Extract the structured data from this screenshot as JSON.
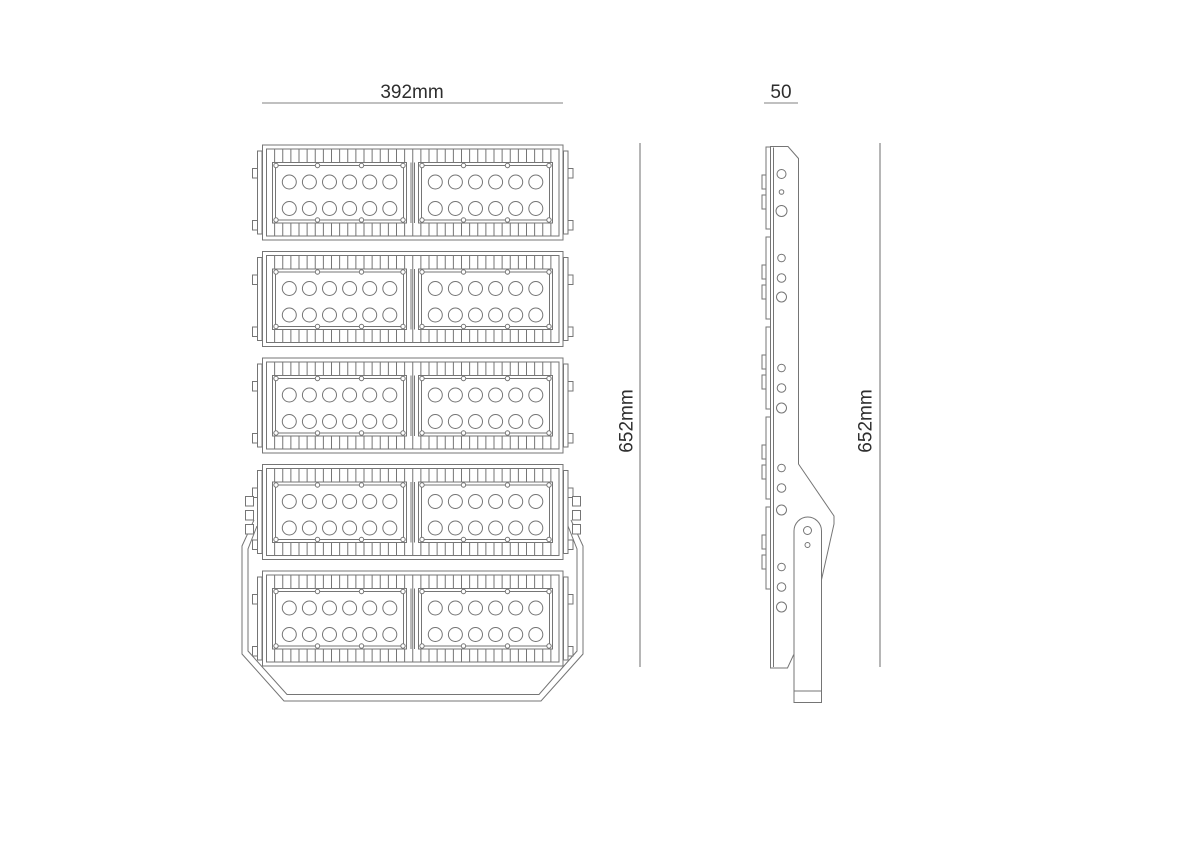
{
  "dimensions": {
    "front_width_label": "392mm",
    "side_width_label": "50",
    "front_height_label": "652mm",
    "side_height_label": "652mm"
  },
  "drawing": {
    "type": "technical-line-drawing",
    "subject": "LED floodlight, front view and side view",
    "front_view": {
      "module_rows": 5,
      "modules_per_row": 2,
      "led_columns_per_module": 6,
      "led_rows_per_module": 2,
      "fins_per_row": 36,
      "screws_per_module": 8,
      "side_tabs_per_row": 2,
      "hinge_tab_cluster_row": 4,
      "hinge_tabs_per_side": 3
    },
    "side_view": {
      "hole_groups": 5,
      "holes_per_group": 3,
      "tab_pairs": 5,
      "bracket_arm_holes": 2,
      "front_strip_segments": 5
    }
  },
  "colors": {
    "background": "#ffffff",
    "line": "#757575",
    "dim_line_horizontal": "#9a9a9a",
    "dim_line_vertical": "#6e6e6e",
    "text": "#2e2e2e"
  }
}
